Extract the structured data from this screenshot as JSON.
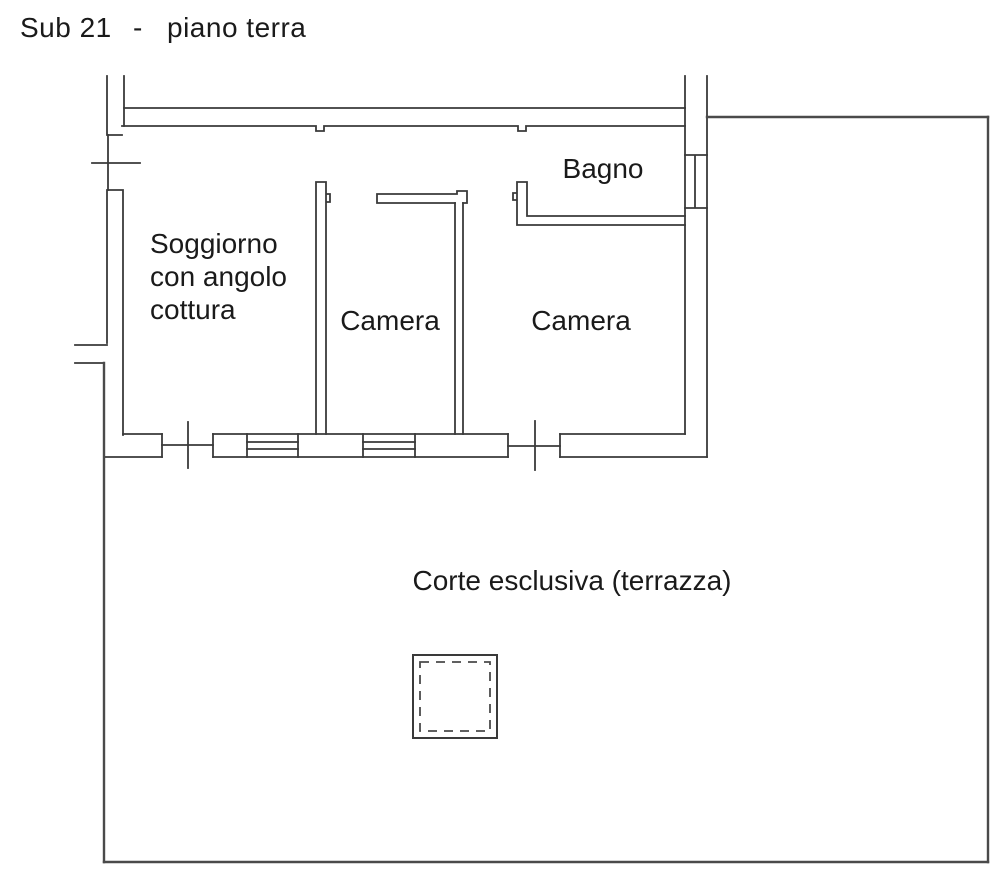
{
  "title": {
    "subunit": "Sub 21",
    "separator": "-",
    "floor_label": "piano terra"
  },
  "colors": {
    "line": "#3a3a3a",
    "boundary_line": "#4a4a4a",
    "text": "#1a1a1a",
    "background": "#ffffff"
  },
  "rooms": [
    {
      "name": "soggiorno",
      "label_lines": [
        "Soggiorno",
        "con angolo",
        "cottura"
      ]
    },
    {
      "name": "camera-1",
      "label": "Camera"
    },
    {
      "name": "camera-2",
      "label": "Camera"
    },
    {
      "name": "bagno",
      "label": "Bagno"
    },
    {
      "name": "corte",
      "label": "Corte esclusiva (terrazza)"
    }
  ]
}
